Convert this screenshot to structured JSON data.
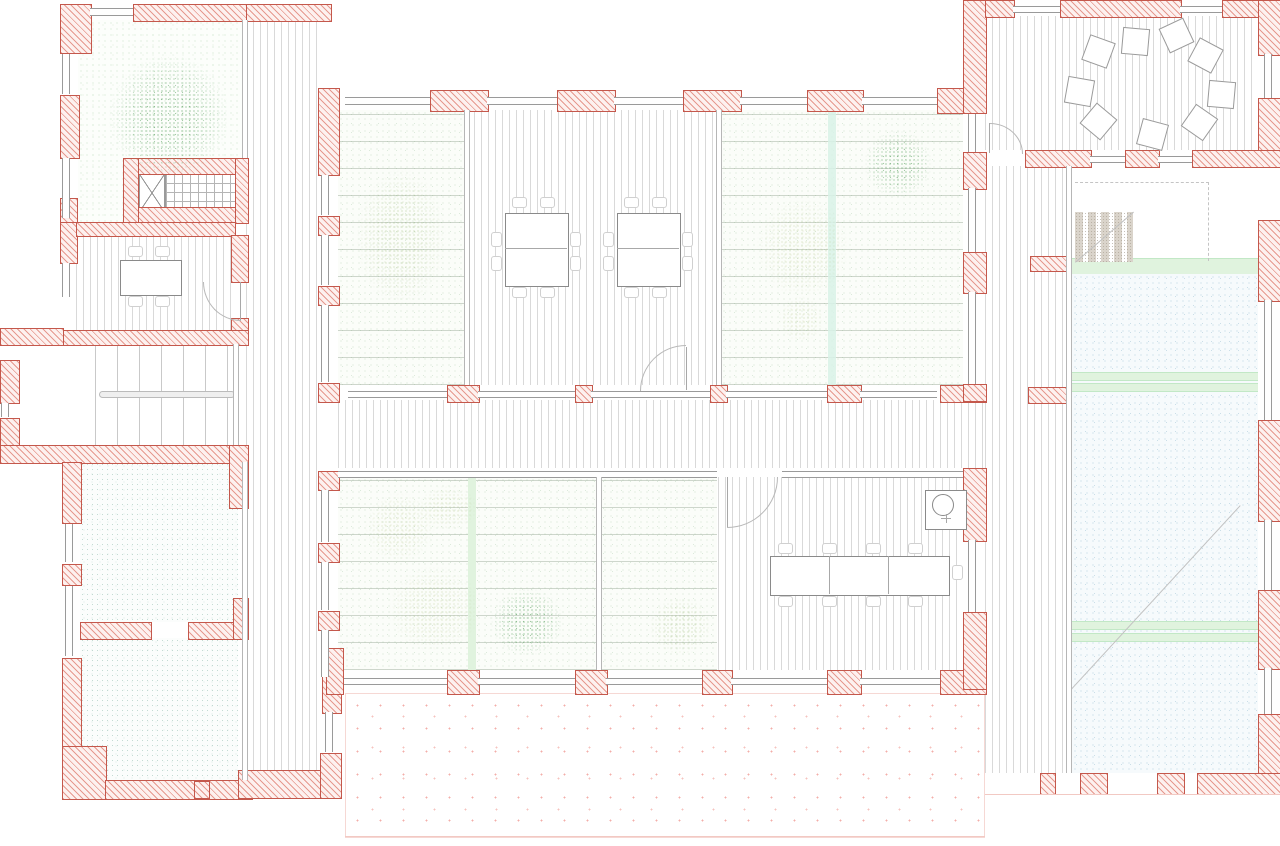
{
  "document": {
    "type": "architectural floor plan",
    "view": "top-down plan drawing",
    "visible_text": "none",
    "wall_convention": "red diagonal hatch = masonry walls and piers",
    "floor_conventions": "thin vertical lines = wood planks; green speckle = planted winter gardens; teal speckle = service rooms; blue speckle = ramp hall; pink dots = outdoor terrace"
  },
  "palette": {
    "wall_line": "#c4584c",
    "wall_hatch": "#e6998f",
    "wall_fill": "#fdf1ef",
    "wood_line": "#d9d9d9",
    "glass_line": "#9a9a9a",
    "partition_line": "#b6b6b6",
    "band_fill": "#e0f3de",
    "band_line": "#c2e8c6",
    "stair_line": "#c9c9c9",
    "dash_line": "#c4c4c4"
  },
  "legend": [
    {
      "pattern": "red-diagonal-hatch",
      "meaning": "load-bearing wall / pier"
    },
    {
      "pattern": "double-thin-line",
      "meaning": "window glazing / glass partition"
    },
    {
      "pattern": "fine-vertical-lines",
      "meaning": "wood plank flooring"
    },
    {
      "pattern": "green-speckle",
      "meaning": "interior planting / winter garden"
    },
    {
      "pattern": "teal-speckle",
      "meaning": "service room floor"
    },
    {
      "pattern": "blue-speckle",
      "meaning": "sloped ramp hall"
    },
    {
      "pattern": "sparse-pink-dots",
      "meaning": "outdoor terrace"
    },
    {
      "pattern": "dashed-line",
      "meaning": "void / opening above"
    }
  ],
  "rooms": [
    {
      "name": "courtyard-garden",
      "feature": "large tree, green ground cover"
    },
    {
      "name": "elevator-and-stair-core",
      "feature": "elevator X symbol, gridded treads"
    },
    {
      "name": "small-meeting-room",
      "feature": "table with 4 chairs, swing door"
    },
    {
      "name": "main-staircase-hall",
      "feature": "two flights with center handrail"
    },
    {
      "name": "service-room-north",
      "feature": "teal speckled floor"
    },
    {
      "name": "service-room-south",
      "feature": "teal speckled floor"
    },
    {
      "name": "north-south-corridor",
      "feature": "wood floor"
    },
    {
      "name": "winter-garden-west",
      "feature": "tall plant"
    },
    {
      "name": "open-office",
      "feature": "two double desks with chairs"
    },
    {
      "name": "winter-garden-east",
      "feature": "palms and tree, mint strip"
    },
    {
      "name": "east-west-corridor",
      "feature": "wood floor, glazed on both sides"
    },
    {
      "name": "winter-garden-south",
      "feature": "palms, trees, green strip"
    },
    {
      "name": "south-meeting-room",
      "feature": "long 3-part table, kitchenette with round sink"
    },
    {
      "name": "south-terrace",
      "feature": "pink stippled paving"
    },
    {
      "name": "lounge",
      "feature": "nine scattered floor cushions"
    },
    {
      "name": "east-corridor",
      "feature": "wood floor"
    },
    {
      "name": "stair-to-lower-level",
      "feature": "stippled treads, dashed void line"
    },
    {
      "name": "ramp-hall",
      "feature": "blue speckled slope, green landings, diagonal slope line"
    }
  ],
  "furniture": {
    "lounge_cushions": [
      {
        "x": 1085,
        "y": 38,
        "r": 20
      },
      {
        "x": 1122,
        "y": 28,
        "r": 5
      },
      {
        "x": 1163,
        "y": 22,
        "r": -25
      },
      {
        "x": 1192,
        "y": 42,
        "r": 28
      },
      {
        "x": 1066,
        "y": 78,
        "r": 10
      },
      {
        "x": 1085,
        "y": 108,
        "r": 40
      },
      {
        "x": 1139,
        "y": 121,
        "r": 15
      },
      {
        "x": 1186,
        "y": 109,
        "r": 35
      },
      {
        "x": 1208,
        "y": 81,
        "r": 5
      }
    ],
    "tables": [
      {
        "x": 120,
        "y": 260,
        "w": 60,
        "h": 34
      },
      {
        "x": 505,
        "y": 213,
        "w": 62,
        "h": 72
      },
      {
        "x": 617,
        "y": 213,
        "w": 62,
        "h": 72
      },
      {
        "x": 770,
        "y": 556,
        "w": 178,
        "h": 38
      }
    ],
    "table_edges": [
      {
        "x": 505,
        "y": 248,
        "w": 62,
        "h": 1
      },
      {
        "x": 617,
        "y": 248,
        "w": 62,
        "h": 1
      },
      {
        "x": 829,
        "y": 556,
        "w": 1,
        "h": 38
      },
      {
        "x": 888,
        "y": 556,
        "w": 1,
        "h": 38
      }
    ],
    "chairs": [
      {
        "x": 128,
        "y": 246,
        "w": 13,
        "h": 9
      },
      {
        "x": 155,
        "y": 246,
        "w": 13,
        "h": 9
      },
      {
        "x": 128,
        "y": 296,
        "w": 13,
        "h": 9
      },
      {
        "x": 155,
        "y": 296,
        "w": 13,
        "h": 9
      },
      {
        "x": 512,
        "y": 197,
        "w": 13,
        "h": 9
      },
      {
        "x": 540,
        "y": 197,
        "w": 13,
        "h": 9
      },
      {
        "x": 512,
        "y": 287,
        "w": 13,
        "h": 9
      },
      {
        "x": 540,
        "y": 287,
        "w": 13,
        "h": 9
      },
      {
        "x": 491,
        "y": 232,
        "w": 9,
        "h": 13
      },
      {
        "x": 491,
        "y": 256,
        "w": 9,
        "h": 13
      },
      {
        "x": 570,
        "y": 232,
        "w": 9,
        "h": 13
      },
      {
        "x": 570,
        "y": 256,
        "w": 9,
        "h": 13
      },
      {
        "x": 624,
        "y": 197,
        "w": 13,
        "h": 9
      },
      {
        "x": 652,
        "y": 197,
        "w": 13,
        "h": 9
      },
      {
        "x": 624,
        "y": 287,
        "w": 13,
        "h": 9
      },
      {
        "x": 652,
        "y": 287,
        "w": 13,
        "h": 9
      },
      {
        "x": 603,
        "y": 232,
        "w": 9,
        "h": 13
      },
      {
        "x": 603,
        "y": 256,
        "w": 9,
        "h": 13
      },
      {
        "x": 682,
        "y": 232,
        "w": 9,
        "h": 13
      },
      {
        "x": 682,
        "y": 256,
        "w": 9,
        "h": 13
      },
      {
        "x": 778,
        "y": 543,
        "w": 13,
        "h": 9
      },
      {
        "x": 822,
        "y": 543,
        "w": 13,
        "h": 9
      },
      {
        "x": 866,
        "y": 543,
        "w": 13,
        "h": 9
      },
      {
        "x": 908,
        "y": 543,
        "w": 13,
        "h": 9
      },
      {
        "x": 778,
        "y": 596,
        "w": 13,
        "h": 9
      },
      {
        "x": 822,
        "y": 596,
        "w": 13,
        "h": 9
      },
      {
        "x": 866,
        "y": 596,
        "w": 13,
        "h": 9
      },
      {
        "x": 908,
        "y": 596,
        "w": 13,
        "h": 9
      },
      {
        "x": 952,
        "y": 565,
        "w": 9,
        "h": 13
      }
    ],
    "plants": [
      {
        "x": 88,
        "y": 33,
        "w": 162,
        "h": 168,
        "c": "dark"
      },
      {
        "x": 340,
        "y": 145,
        "w": 122,
        "h": 185,
        "c": "light"
      },
      {
        "x": 852,
        "y": 118,
        "w": 92,
        "h": 92,
        "c": "dark"
      },
      {
        "x": 740,
        "y": 180,
        "w": 125,
        "h": 135,
        "c": "palm"
      },
      {
        "x": 770,
        "y": 288,
        "w": 62,
        "h": 62,
        "c": "palm"
      },
      {
        "x": 408,
        "y": 477,
        "w": 80,
        "h": 62,
        "c": "palm"
      },
      {
        "x": 352,
        "y": 480,
        "w": 95,
        "h": 95,
        "c": "palm"
      },
      {
        "x": 372,
        "y": 550,
        "w": 125,
        "h": 118,
        "c": "palm"
      },
      {
        "x": 478,
        "y": 576,
        "w": 98,
        "h": 92,
        "c": "dark"
      },
      {
        "x": 638,
        "y": 586,
        "w": 85,
        "h": 80,
        "c": "light"
      }
    ]
  }
}
